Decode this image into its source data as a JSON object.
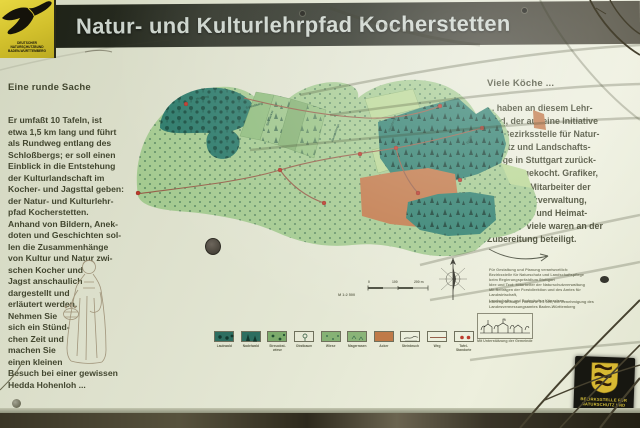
{
  "header": {
    "title": "Natur- und Kulturlehrpfad Kocherstetten",
    "logo_text": "DEUTSCHER\nNATURSCHUTZBUND\nBADEN-WÜRTTEMBERG"
  },
  "columns": {
    "left": {
      "heading": "Eine runde Sache",
      "body": "Er umfaßt 10 Tafeln, ist\netwa 1,5 km lang und führt\nals Rundweg entlang des\nSchloßbergs; er soll einen\nEinblick in die Entstehung\nder Kulturlandschaft im\nKocher- und Jagsttal geben:\nder Natur- und Kulturlehr-\npfad Kocherstetten.\nAnhand von Bildern, Anek-\ndoten und Geschichten sol-\nlen die Zusammenhänge\nvon Kultur und Natur zwi-\nschen Kocher und\nJagst anschaulich\ndargestellt und\nerläutert werden.\nNehmen Sie\nsich ein Stünd-\nchen Zeit und\nmachen Sie\neinen kleinen\nBesuch bei einer gewissen\nHedda Hohenloh ..."
    },
    "right": {
      "heading": "Viele Köche ...",
      "body": "... haben an diesem Lehr-\npfad, der auf eine Initiative\nder Bezirksstelle für Natur-\nschutz und Landschafts-\npflege in Stuttgart zurück-\ngeht, mitgekocht. Grafiker,\nBiologen, Mitarbeiter der\nNaturschutzverwaltung,\nOrtskenner und Heimat-\nkundler - viele waren an der\nZubereitung beteiligt."
    }
  },
  "map": {
    "labels": [
      "Schloßberg",
      "Heerweg",
      "Steinäcker",
      "Hasenklinge",
      "Weinberg",
      "Breite"
    ],
    "scale": {
      "t0": "0",
      "t1": "100",
      "t2": "200 m",
      "ratio": "M 1:2 500"
    }
  },
  "credits": {
    "block1": "Für Gestaltung und Planung verantwortlich:\nBezirksstelle für Naturschutz und Landschaftspflege\nbeim Regierungspräsidium Stuttgart\nIdee und Text: Mitarbeiter der Naturschutzverwaltung\nMit Beiträgen der Forstdirektion und des Amtes für Landwirtschaft,\nLandschafts- und Bodenkultur Künzelsau",
    "block2": "Kartengrundlage: Flurkarte 1:2 500, mit Genehmigung des\nLandesvermessungsamtes Baden-Württemberg",
    "caption": "Mit Unterstützung der Gemeinde"
  },
  "legend": {
    "items": [
      {
        "label": "Laubwald"
      },
      {
        "label": "Nadelwald"
      },
      {
        "label": "Streuobst-\nwiese"
      },
      {
        "label": "Obstbaum"
      },
      {
        "label": "Wiese"
      },
      {
        "label": "Magerrasen"
      },
      {
        "label": "Acker"
      },
      {
        "label": "Steinbruch"
      },
      {
        "label": "Weg"
      },
      {
        "label": "Tafel-\nStandorte"
      }
    ]
  },
  "plaque": {
    "text": "BEZIRKSSTELLE FÜR\nNATURSCHUTZ UND\nLANDSCHAFTSPFLEGE"
  },
  "palette": {
    "board": "#dfe2cf",
    "title_bar": "#2e3126",
    "title_text": "#cbd3cb",
    "logo_yellow": "#ddc832",
    "meadow_green": "#a4ca90",
    "forest_teal": "#2e7a6a",
    "field_orange": "#c1794a",
    "station_red": "#bb3a2c",
    "plaque_gold": "#d7b832"
  }
}
